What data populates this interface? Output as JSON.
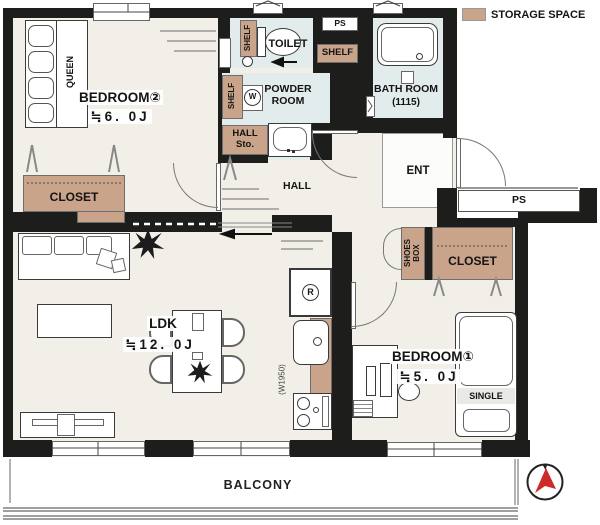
{
  "legend": {
    "label": "STORAGE SPACE"
  },
  "rooms": {
    "bedroom2": {
      "name": "BEDROOM②",
      "size": "≒6. 0J"
    },
    "ldk": {
      "name": "LDK",
      "size": "≒12. 0J"
    },
    "bedroom1": {
      "name": "BEDROOM①",
      "size": "≒5. 0J"
    },
    "toilet": {
      "name": "TOILET"
    },
    "powder": {
      "name": "POWDER\nROOM"
    },
    "bath": {
      "name": "BATH ROOM",
      "size": "(1115)"
    },
    "ent": {
      "name": "ENT"
    },
    "hall": {
      "name": "HALL"
    },
    "balcony": {
      "name": "BALCONY"
    }
  },
  "storage": {
    "closet_bedroom2": "CLOSET",
    "closet_bedroom1": "CLOSET",
    "shelf_toilet": "SHELF",
    "shelf_powder": "SHELF",
    "shelf_wall": "SHELF",
    "hall_storage": "HALL\nSto.",
    "shoes_box": "SHOES\nBOX"
  },
  "fixtures": {
    "queen_bed": "QUEEN",
    "single_bed": "SINGLE",
    "washer": "W",
    "fridge": "R",
    "ps_top": "PS",
    "ps_right": "PS",
    "kitchen_width": "(W1950)"
  },
  "colors": {
    "wall": "#1d1d1b",
    "floor": "#f2efe8",
    "wet_area": "#e3ecec",
    "storage": "#c9a38a",
    "needle_red": "#cc2b29"
  }
}
